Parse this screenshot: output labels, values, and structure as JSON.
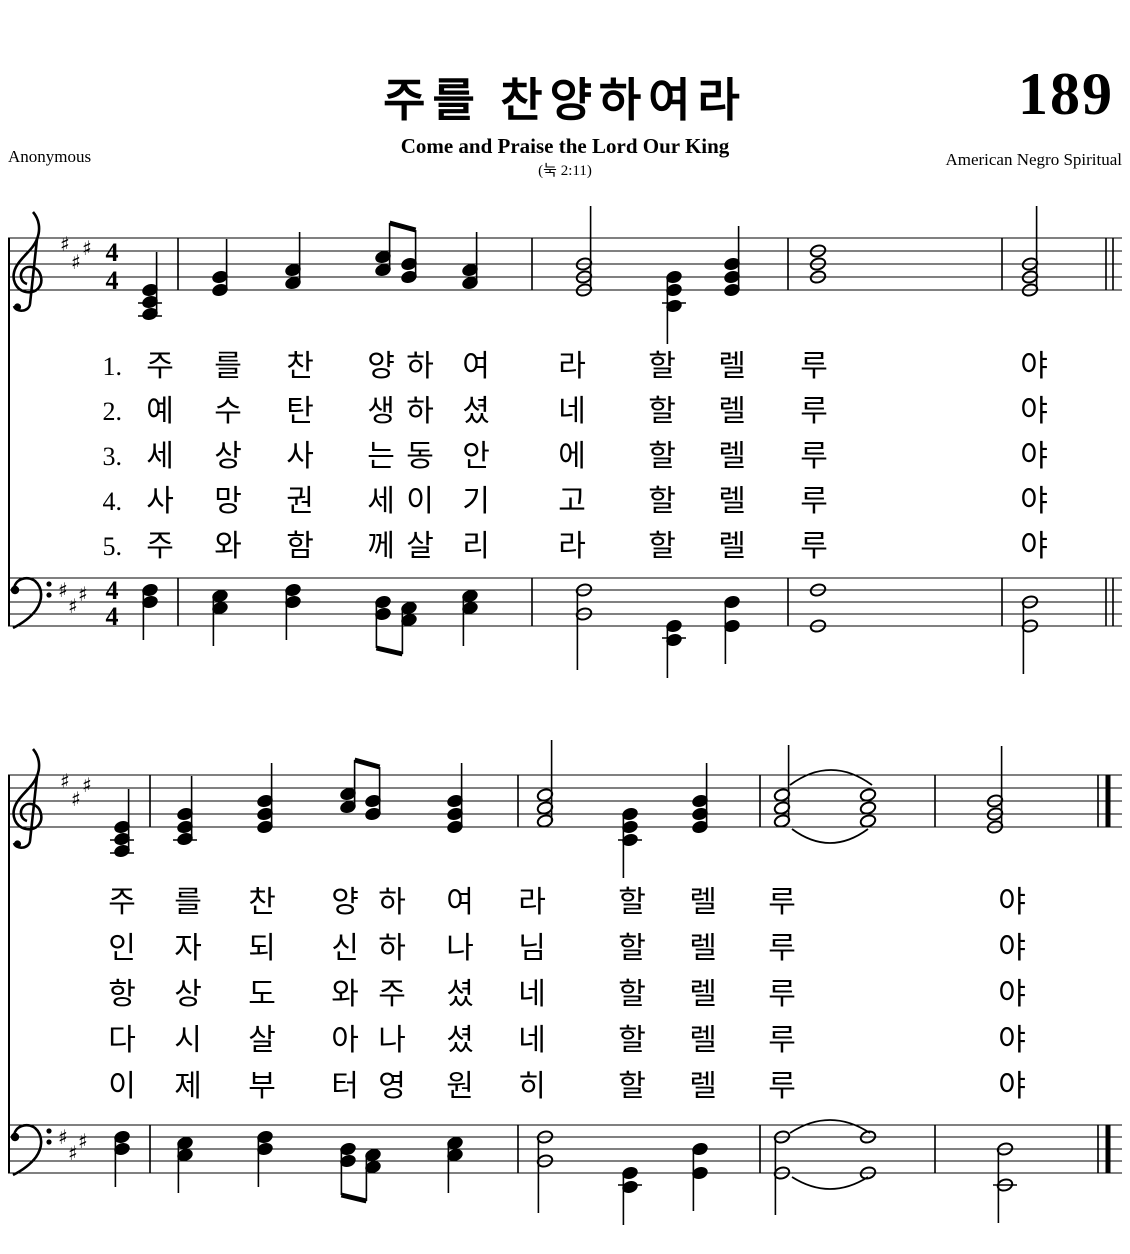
{
  "header": {
    "hymn_number": "189",
    "title": "주를 찬양하여라",
    "subtitle": "Come and Praise the Lord Our King",
    "scripture_ref": "(눅 2:11)",
    "lyricist": "Anonymous",
    "source": "American Negro Spiritual"
  },
  "verse_numbers": [
    "1.",
    "2.",
    "3.",
    "4.",
    "5."
  ],
  "verses": [
    "주를 찬양하여라 할렐루야 주를 찬양하여라 할렐루야",
    "예수 탄생하셨네 할렐루야 인자되신 하나님 할렐루야",
    "세상 사는 동안에 할렐루야 항상 도와주셨네 할렐루야",
    "사망권세 이기고 할렐루야 다시 살아나셨네 할렐루야",
    "주와 함께 살리라 할렐루야 이제부터 영원히 할렐루야"
  ],
  "lyrics": {
    "system1": {
      "rows_top": 344,
      "row_height": 45,
      "verse_num_x": 86,
      "columns": [
        {
          "x": 160,
          "chars": [
            "주",
            "예",
            "세",
            "사",
            "주"
          ]
        },
        {
          "x": 228,
          "chars": [
            "를",
            "수",
            "상",
            "망",
            "와"
          ]
        },
        {
          "x": 300,
          "chars": [
            "찬",
            "탄",
            "사",
            "권",
            "함"
          ]
        },
        {
          "x": 381,
          "chars": [
            "양",
            "생",
            "는",
            "세",
            "께"
          ]
        },
        {
          "x": 420,
          "chars": [
            "하",
            "하",
            "동",
            "이",
            "살"
          ]
        },
        {
          "x": 476,
          "chars": [
            "여",
            "셨",
            "안",
            "기",
            "리"
          ]
        },
        {
          "x": 572,
          "chars": [
            "라",
            "네",
            "에",
            "고",
            "라"
          ]
        },
        {
          "x": 662,
          "chars": [
            "할",
            "할",
            "할",
            "할",
            "할"
          ]
        },
        {
          "x": 732,
          "chars": [
            "렐",
            "렐",
            "렐",
            "렐",
            "렐"
          ]
        },
        {
          "x": 814,
          "chars": [
            "루",
            "루",
            "루",
            "루",
            "루"
          ]
        },
        {
          "x": 1034,
          "chars": [
            "야",
            "야",
            "야",
            "야",
            "야"
          ]
        }
      ]
    },
    "system2": {
      "rows_top": 880,
      "row_height": 46,
      "verse_num_x": null,
      "columns": [
        {
          "x": 122,
          "chars": [
            "주",
            "인",
            "항",
            "다",
            "이"
          ]
        },
        {
          "x": 188,
          "chars": [
            "를",
            "자",
            "상",
            "시",
            "제"
          ]
        },
        {
          "x": 262,
          "chars": [
            "찬",
            "되",
            "도",
            "살",
            "부"
          ]
        },
        {
          "x": 345,
          "chars": [
            "양",
            "신",
            "와",
            "아",
            "터"
          ]
        },
        {
          "x": 392,
          "chars": [
            "하",
            "하",
            "주",
            "나",
            "영"
          ]
        },
        {
          "x": 460,
          "chars": [
            "여",
            "나",
            "셨",
            "셨",
            "원"
          ]
        },
        {
          "x": 532,
          "chars": [
            "라",
            "님",
            "네",
            "네",
            "히"
          ]
        },
        {
          "x": 632,
          "chars": [
            "할",
            "할",
            "할",
            "할",
            "할"
          ]
        },
        {
          "x": 703,
          "chars": [
            "렐",
            "렐",
            "렐",
            "렐",
            "렐"
          ]
        },
        {
          "x": 782,
          "chars": [
            "루",
            "루",
            "루",
            "루",
            "루"
          ]
        },
        {
          "x": 1012,
          "chars": [
            "야",
            "야",
            "야",
            "야",
            "야"
          ]
        }
      ]
    }
  },
  "notation": {
    "key_signature": "3 sharps",
    "time_signature": [
      "4",
      "4"
    ],
    "system_braces": [
      {
        "x": 8,
        "y1": 238,
        "y2": 626
      },
      {
        "x": 8,
        "y1": 775,
        "y2": 1173
      }
    ],
    "staves": [
      {
        "name": "system1-treble",
        "top": 198,
        "spacing": 13,
        "clef": "treble",
        "sharps": [
          [
            60,
            46
          ],
          [
            71,
            64
          ],
          [
            82,
            50
          ]
        ],
        "time": true,
        "barlines": [
          178,
          532,
          788,
          1002
        ],
        "end": {
          "lines": [
            1106,
            1113
          ],
          "thick": false
        },
        "notes": [
          {
            "x": 150,
            "heads": [
              92,
              104,
              116
            ],
            "open": false,
            "stem": "up",
            "ledgers": [
              105,
              118
            ]
          },
          {
            "x": 220,
            "heads": [
              79,
              92
            ],
            "open": false,
            "stem": "up"
          },
          {
            "x": 293,
            "heads": [
              72,
              85
            ],
            "open": false,
            "stem": "up"
          },
          {
            "pair": true,
            "x1": 383,
            "x2": 409,
            "heads1": [
              59,
              72
            ],
            "heads2": [
              66,
              79
            ]
          },
          {
            "x": 470,
            "heads": [
              72,
              85
            ],
            "open": false,
            "stem": "up"
          },
          {
            "x": 584,
            "heads": [
              66,
              79,
              92
            ],
            "open": true,
            "stem": "up",
            "stemlen": 58
          },
          {
            "x": 674,
            "heads": [
              79,
              92,
              108
            ],
            "open": false,
            "stem": "down",
            "ledgers": [
              105
            ]
          },
          {
            "x": 732,
            "heads": [
              66,
              79,
              92
            ],
            "open": false,
            "stem": "up"
          },
          {
            "x": 818,
            "heads": [
              53,
              66,
              79
            ],
            "open": true,
            "whole": true
          },
          {
            "x": 1030,
            "heads": [
              66,
              79,
              92
            ],
            "open": true,
            "stem": "up",
            "stemlen": 58
          }
        ],
        "arcs": []
      },
      {
        "name": "system1-bass",
        "top": 538,
        "spacing": 12,
        "clef": "bass",
        "sharps": [
          [
            58,
            52
          ],
          [
            68,
            68
          ],
          [
            78,
            56
          ]
        ],
        "time": true,
        "barlines": [
          178,
          532,
          788,
          1002
        ],
        "end": {
          "lines": [
            1106,
            1113
          ],
          "thick": false
        },
        "notes": [
          {
            "x": 150,
            "heads": [
              52,
              64
            ],
            "open": false,
            "stem": "down"
          },
          {
            "x": 220,
            "heads": [
              58,
              70
            ],
            "open": false,
            "stem": "down"
          },
          {
            "x": 293,
            "heads": [
              52,
              64
            ],
            "open": false,
            "stem": "down"
          },
          {
            "pair": true,
            "x1": 383,
            "x2": 409,
            "heads1": [
              64,
              76
            ],
            "heads2": [
              70,
              82
            ],
            "below": true
          },
          {
            "x": 470,
            "heads": [
              58,
              70
            ],
            "open": false,
            "stem": "down"
          },
          {
            "x": 584,
            "heads": [
              52,
              76
            ],
            "open": true,
            "stem": "down",
            "stemlen": 56
          },
          {
            "x": 674,
            "heads": [
              88,
              102
            ],
            "open": false,
            "stem": "down",
            "ledgers": [
              100
            ]
          },
          {
            "x": 732,
            "heads": [
              64,
              88
            ],
            "open": false,
            "stem": "down"
          },
          {
            "x": 818,
            "heads": [
              52,
              88
            ],
            "open": true,
            "whole": true
          },
          {
            "x": 1030,
            "heads": [
              64,
              88
            ],
            "open": true,
            "stem": "down",
            "stemlen": 48
          }
        ],
        "arcs": []
      },
      {
        "name": "system2-treble",
        "top": 735,
        "spacing": 13,
        "clef": "treble",
        "sharps": [
          [
            60,
            46
          ],
          [
            71,
            64
          ],
          [
            82,
            50
          ]
        ],
        "time": false,
        "barlines": [
          150,
          518,
          760,
          935
        ],
        "end": {
          "lines": [
            1098,
            1108
          ],
          "thick": true
        },
        "notes": [
          {
            "x": 122,
            "heads": [
              92,
              104,
              116
            ],
            "open": false,
            "stem": "up",
            "ledgers": [
              105,
              118
            ]
          },
          {
            "x": 185,
            "heads": [
              79,
              92,
              104
            ],
            "open": false,
            "stem": "up",
            "ledgers": [
              105
            ]
          },
          {
            "x": 265,
            "heads": [
              66,
              79,
              92
            ],
            "open": false,
            "stem": "up"
          },
          {
            "pair": true,
            "x1": 348,
            "x2": 373,
            "heads1": [
              59,
              72
            ],
            "heads2": [
              66,
              79
            ]
          },
          {
            "x": 455,
            "heads": [
              66,
              79,
              92
            ],
            "open": false,
            "stem": "up"
          },
          {
            "x": 545,
            "heads": [
              60,
              73,
              86
            ],
            "open": true,
            "stem": "up",
            "stemlen": 55
          },
          {
            "x": 630,
            "heads": [
              79,
              92,
              105
            ],
            "open": false,
            "stem": "down",
            "ledgers": [
              105
            ]
          },
          {
            "x": 700,
            "heads": [
              66,
              79,
              92
            ],
            "open": false,
            "stem": "up"
          },
          {
            "x": 782,
            "heads": [
              60,
              73,
              86
            ],
            "open": true,
            "stem": "up",
            "stemlen": 50
          },
          {
            "x": 868,
            "heads": [
              60,
              73,
              86
            ],
            "open": true,
            "whole": true
          },
          {
            "x": 995,
            "heads": [
              66,
              79,
              92
            ],
            "open": true,
            "stem": "up",
            "stemlen": 55
          }
        ],
        "arcs": [
          {
            "x1": 790,
            "y1": 50,
            "x2": 872,
            "y2": 50,
            "peak": -30
          },
          {
            "x1": 792,
            "y1": 94,
            "x2": 868,
            "y2": 94,
            "peak": 28
          }
        ]
      },
      {
        "name": "system2-bass",
        "top": 1085,
        "spacing": 12,
        "clef": "bass",
        "sharps": [
          [
            58,
            52
          ],
          [
            68,
            68
          ],
          [
            78,
            56
          ]
        ],
        "time": false,
        "barlines": [
          150,
          518,
          760,
          935
        ],
        "end": {
          "lines": [
            1098,
            1108
          ],
          "thick": true
        },
        "notes": [
          {
            "x": 122,
            "heads": [
              52,
              64
            ],
            "open": false,
            "stem": "down"
          },
          {
            "x": 185,
            "heads": [
              58,
              70
            ],
            "open": false,
            "stem": "down"
          },
          {
            "x": 265,
            "heads": [
              52,
              64
            ],
            "open": false,
            "stem": "down"
          },
          {
            "pair": true,
            "x1": 348,
            "x2": 373,
            "heads1": [
              64,
              76
            ],
            "heads2": [
              70,
              82
            ],
            "below": true
          },
          {
            "x": 455,
            "heads": [
              58,
              70
            ],
            "open": false,
            "stem": "down"
          },
          {
            "x": 545,
            "heads": [
              52,
              76
            ],
            "open": true,
            "stem": "down",
            "stemlen": 52
          },
          {
            "x": 630,
            "heads": [
              88,
              102
            ],
            "open": false,
            "stem": "down",
            "ledgers": [
              100
            ]
          },
          {
            "x": 700,
            "heads": [
              64,
              88
            ],
            "open": false,
            "stem": "down"
          },
          {
            "x": 782,
            "heads": [
              52,
              88
            ],
            "open": true,
            "stem": "down",
            "stemlen": 42
          },
          {
            "x": 868,
            "heads": [
              52,
              88
            ],
            "open": true,
            "whole": true
          },
          {
            "x": 1005,
            "heads": [
              64,
              100
            ],
            "open": true,
            "stem": "down",
            "stemlen": 38,
            "ledgers": [
              100
            ]
          }
        ],
        "arcs": [
          {
            "x1": 790,
            "y1": 48,
            "x2": 870,
            "y2": 48,
            "peak": -26
          },
          {
            "x1": 792,
            "y1": 92,
            "x2": 868,
            "y2": 92,
            "peak": 24
          }
        ]
      }
    ]
  },
  "colors": {
    "ink": "#000000",
    "paper": "#ffffff"
  }
}
